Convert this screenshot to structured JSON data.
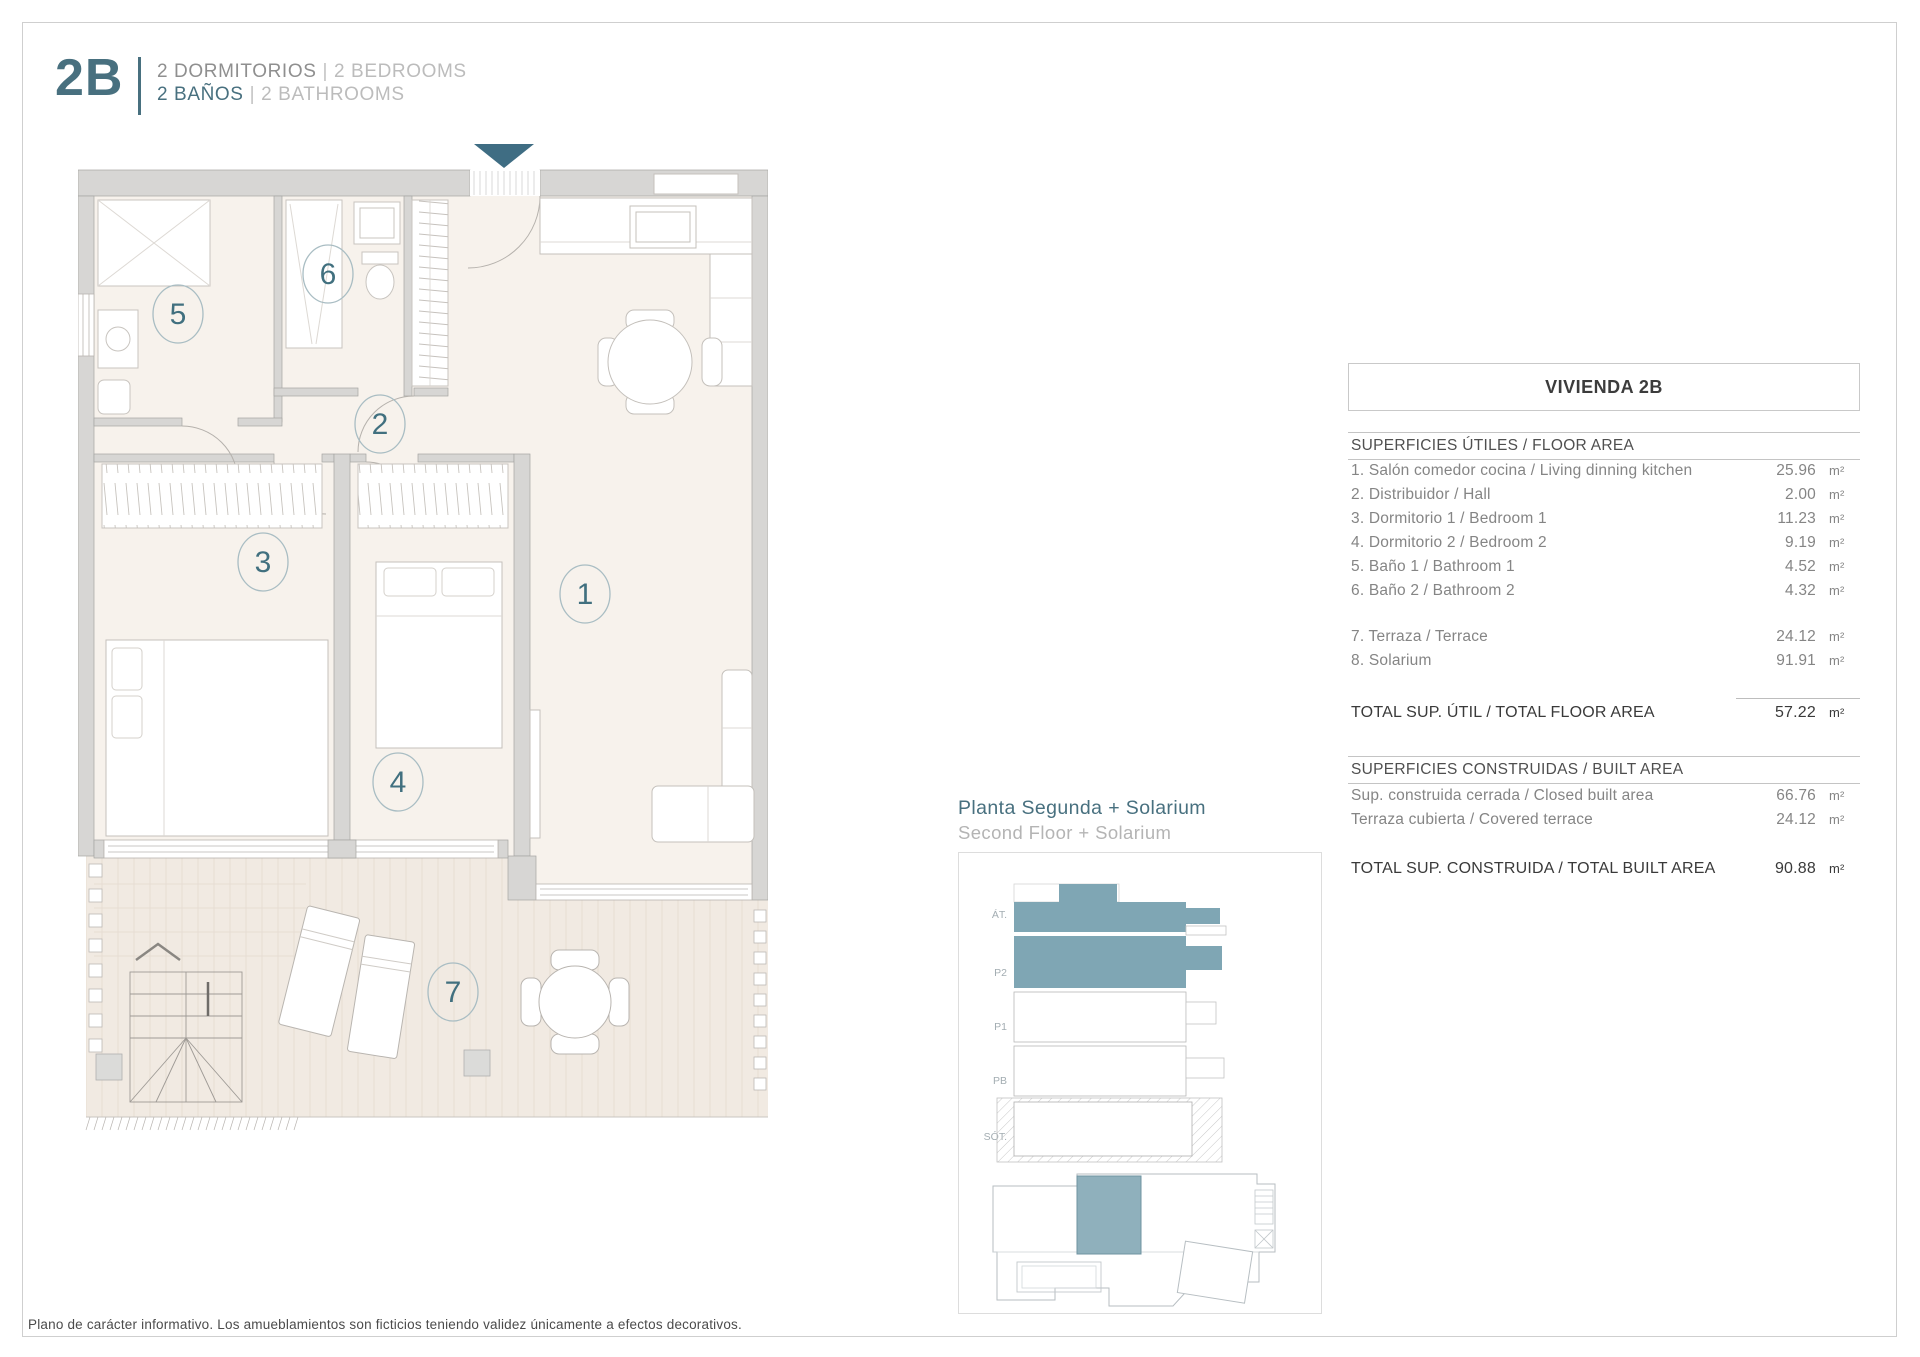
{
  "header": {
    "unit_code": "2B",
    "bedrooms_es": "2 DORMITORIOS",
    "bedrooms_en": "2 BEDROOMS",
    "baths_es": "2 BAÑOS",
    "baths_en": "2 BATHROOMS",
    "sep": "|"
  },
  "plan": {
    "rooms": [
      {
        "number": "1"
      },
      {
        "number": "2"
      },
      {
        "number": "3"
      },
      {
        "number": "4"
      },
      {
        "number": "5"
      },
      {
        "number": "6"
      },
      {
        "number": "7"
      }
    ]
  },
  "location": {
    "title_es": "Planta Segunda + Solarium",
    "title_en": "Second Floor + Solarium",
    "floor_labels": [
      "ÁT.",
      "P2",
      "P1",
      "PB",
      "SÓT."
    ]
  },
  "table": {
    "title": "VIVIENDA 2B",
    "floor_section": "SUPERFICIES ÚTILES / FLOOR AREA",
    "floor_rows": [
      {
        "label": "1. Salón comedor cocina / Living dinning kitchen",
        "value": "25.96",
        "unit": "m²"
      },
      {
        "label": "2. Distribuidor / Hall",
        "value": "2.00",
        "unit": "m²"
      },
      {
        "label": "3. Dormitorio 1 / Bedroom 1",
        "value": "11.23",
        "unit": "m²"
      },
      {
        "label": "4. Dormitorio 2 / Bedroom 2",
        "value": "9.19",
        "unit": "m²"
      },
      {
        "label": "5. Baño 1 / Bathroom 1",
        "value": "4.52",
        "unit": "m²"
      },
      {
        "label": "6. Baño 2 / Bathroom 2",
        "value": "4.32",
        "unit": "m²"
      }
    ],
    "extra_rows": [
      {
        "label": "7. Terraza / Terrace",
        "value": "24.12",
        "unit": "m²"
      },
      {
        "label": "8. Solarium",
        "value": "91.91",
        "unit": "m²"
      }
    ],
    "total_floor": {
      "label": "TOTAL SUP. ÚTIL / TOTAL FLOOR AREA",
      "value": "57.22",
      "unit": "m²"
    },
    "built_section": "SUPERFICIES CONSTRUIDAS / BUILT AREA",
    "built_rows": [
      {
        "label": "Sup. construida cerrada / Closed built area",
        "value": "66.76",
        "unit": "m²"
      },
      {
        "label": "Terraza cubierta / Covered terrace",
        "value": "24.12",
        "unit": "m²"
      }
    ],
    "total_built": {
      "label": "TOTAL SUP. CONSTRUIDA /  TOTAL BUILT AREA",
      "value": "90.88",
      "unit": "m²"
    }
  },
  "footer": {
    "disclaimer": "Plano de carácter informativo. Los amueblamientos son ficticios teniendo validez únicamente a efectos decorativos."
  },
  "colors": {
    "accent_teal": "#48707f",
    "arrow_teal": "#3f6d83",
    "highlight_unit": "#8fb0bc",
    "highlight_floor": "#7fa6b4",
    "wall_gray": "#d7d6d4",
    "floor_beige": "#f7f2ec",
    "terrace_beige": "#f1eae2"
  }
}
